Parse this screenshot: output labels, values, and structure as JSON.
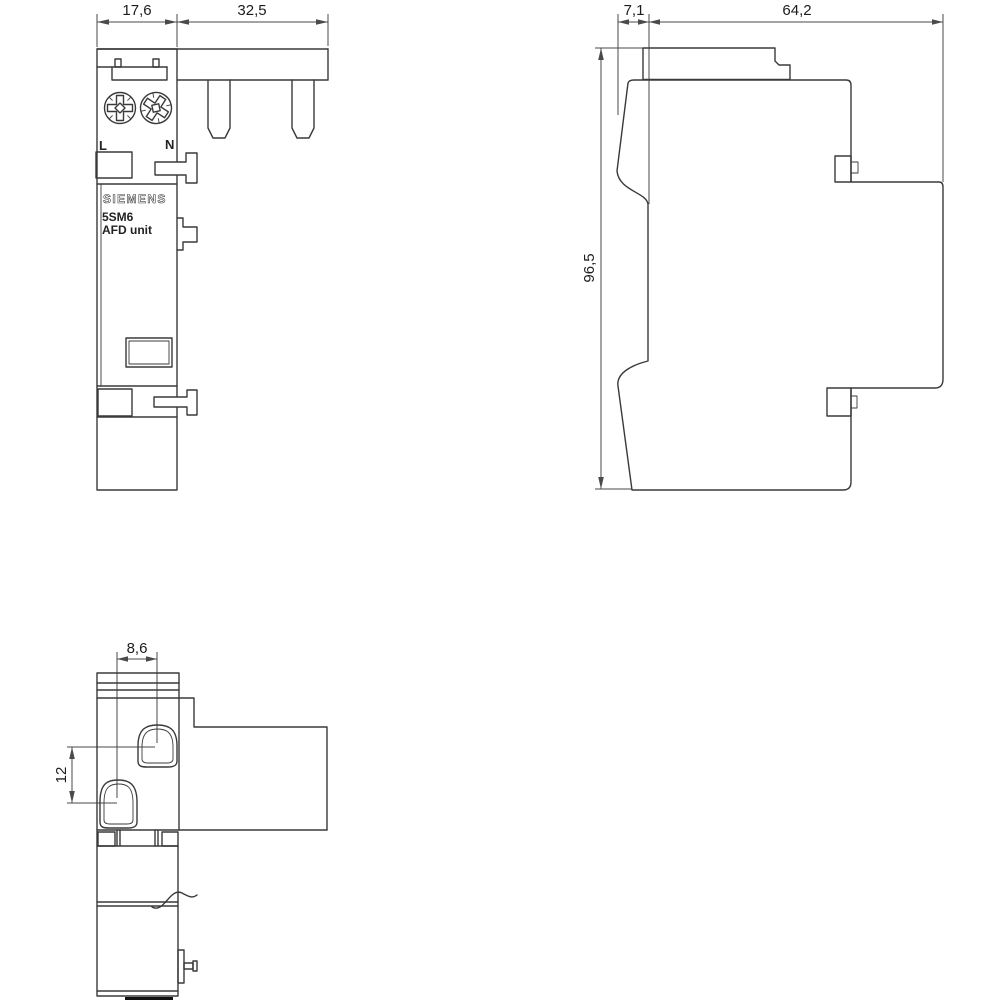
{
  "drawing": {
    "title": "5SM6 AFD unit dimensional drawing",
    "dimensions": {
      "front_width": "17,6",
      "busbar_width": "32,5",
      "nose_depth": "7,1",
      "total_depth": "64,2",
      "total_height": "96,5",
      "terminal_dx": "8,6",
      "terminal_dy": "12"
    },
    "labels": {
      "brand": "SIEMENS",
      "model": "5SM6",
      "model_sub": "AFD unit",
      "terminal_l": "L",
      "terminal_n": "N"
    },
    "colors": {
      "line": "#3a3a3a",
      "dim_line": "#4a4a4a",
      "text": "#1c1c1c",
      "background": "#ffffff",
      "solid_mark": "#111111"
    }
  }
}
